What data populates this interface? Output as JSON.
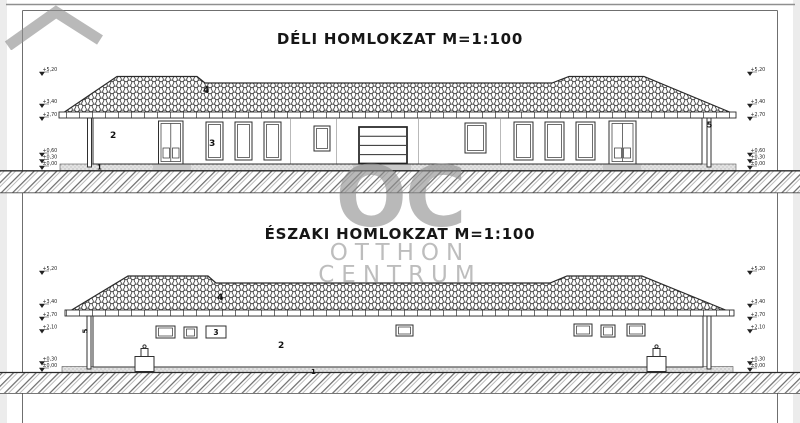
{
  "south": {
    "title": "DÉLI HOMLOKZAT M=1:100",
    "markers_left": [
      "+5,20",
      "+3,40",
      "+2,70",
      "+0,60",
      "+0,30",
      "±0,00"
    ],
    "markers_right": [
      "+5,20",
      "+3,40",
      "+2,70",
      "+0,60",
      "+0,30",
      "±0,00"
    ],
    "labels": {
      "l1": "1",
      "l2": "2",
      "l3": "3",
      "l4": "4",
      "l5": "5"
    }
  },
  "north": {
    "title": "ÉSZAKI HOMLOKZAT M=1:100",
    "markers_left": [
      "+5,20",
      "+3,40",
      "+2,70",
      "+2,10",
      "+0,30",
      "±0,00"
    ],
    "markers_right": [
      "+5,20",
      "+3,40",
      "+2,70",
      "+2,10",
      "+0,30",
      "±0,00"
    ],
    "labels": {
      "l1": "1",
      "l2": "2",
      "l3": "3",
      "l4": "4",
      "l5": "5"
    }
  },
  "watermark": {
    "monogram": "OC",
    "line1": "OTTHON",
    "line2": "CENTRUM",
    "color": "#8f8f8f"
  },
  "colors": {
    "line": "#2b2b2b",
    "paper": "#ffffff",
    "hatch": "#555555"
  }
}
